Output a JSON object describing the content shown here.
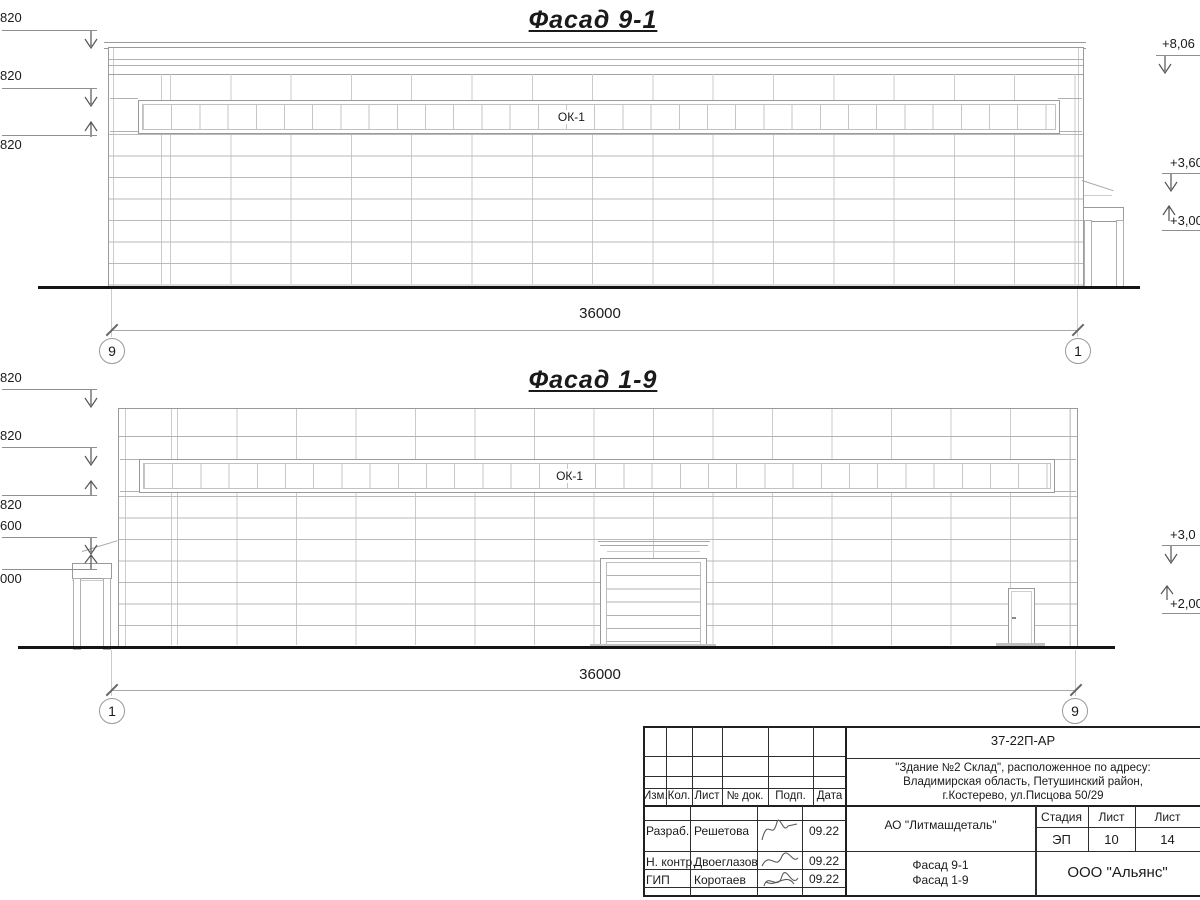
{
  "f1": {
    "title": "Фасад 9-1",
    "ok": "ОК-1",
    "dim": "36000",
    "axisL": "9",
    "axisR": "1",
    "mL": [
      "820",
      "820",
      "820"
    ],
    "mR": [
      "+8,06",
      "+3,60",
      "+3,00"
    ]
  },
  "f2": {
    "title": "Фасад 1-9",
    "ok": "ОК-1",
    "dim": "36000",
    "axisL": "1",
    "axisR": "9",
    "mL": [
      "820",
      "820",
      "820",
      "600",
      "000"
    ],
    "mR": [
      "+3,0",
      "+2,00"
    ]
  },
  "tb": {
    "doc": "37-22П-АР",
    "addr1": "\"Здание №2 Склад\", расположенное по адресу:",
    "addr2": "Владимирская область, Петушинский район,",
    "addr3": "г.Костерево, ул.Писцова 50/29",
    "h": [
      "Изм.",
      "Кол.",
      "Лист",
      "№ док.",
      "Подп.",
      "Дата"
    ],
    "r1_role": "Разраб.",
    "r1_name": "Решетова",
    "r1_date": "09.22",
    "r2_role": "Н. контр.",
    "r2_name": "Двоеглазов",
    "r2_date": "09.22",
    "r3_role": "ГИП",
    "r3_name": "Коротаев",
    "r3_date": "09.22",
    "company": "АО \"Литмашдеталь\"",
    "stage_h": "Стадия",
    "sheet_h": "Лист",
    "sheets_h": "Лист",
    "stage": "ЭП",
    "sheet": "10",
    "sheets": "14",
    "t1": "Фасад 9-1",
    "t2": "Фасад 1-9",
    "org": "ООО \"Альянс\""
  }
}
